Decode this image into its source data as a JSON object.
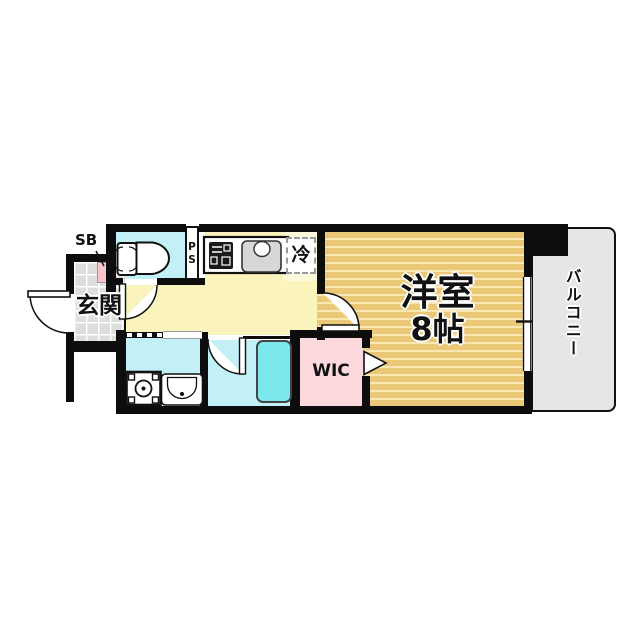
{
  "labels": {
    "entrance": "玄関",
    "shoe_box": "SB",
    "pipe_space": "PS",
    "refrigerator": "冷",
    "main_room_name": "洋室",
    "main_room_size": "8帖",
    "walk_in_closet": "WIC",
    "balcony": "バルコニー"
  },
  "colors": {
    "wall": "#0d0d0d",
    "tan": "#ebc878",
    "stripe": "#f8e7b2",
    "yellow": "#faf3bc",
    "pale": "#fcf9da",
    "cyan": "#c3eff7",
    "tub": "#7de8ec",
    "pink": "#fbd9dd",
    "sbpink": "#f7c5cb",
    "tile": "#dedede",
    "balcony": "#e6e6e6"
  },
  "icons": {
    "toilet": "toilet-icon",
    "stove": "stove-icon",
    "kitchen_sink": "kitchen-sink-icon",
    "washing_machine": "washing-machine-icon",
    "vanity_sink": "vanity-sink-icon",
    "bathtub": "bathtub-icon",
    "door_arcs": "door-swing-arc",
    "window": "window-symbol"
  }
}
